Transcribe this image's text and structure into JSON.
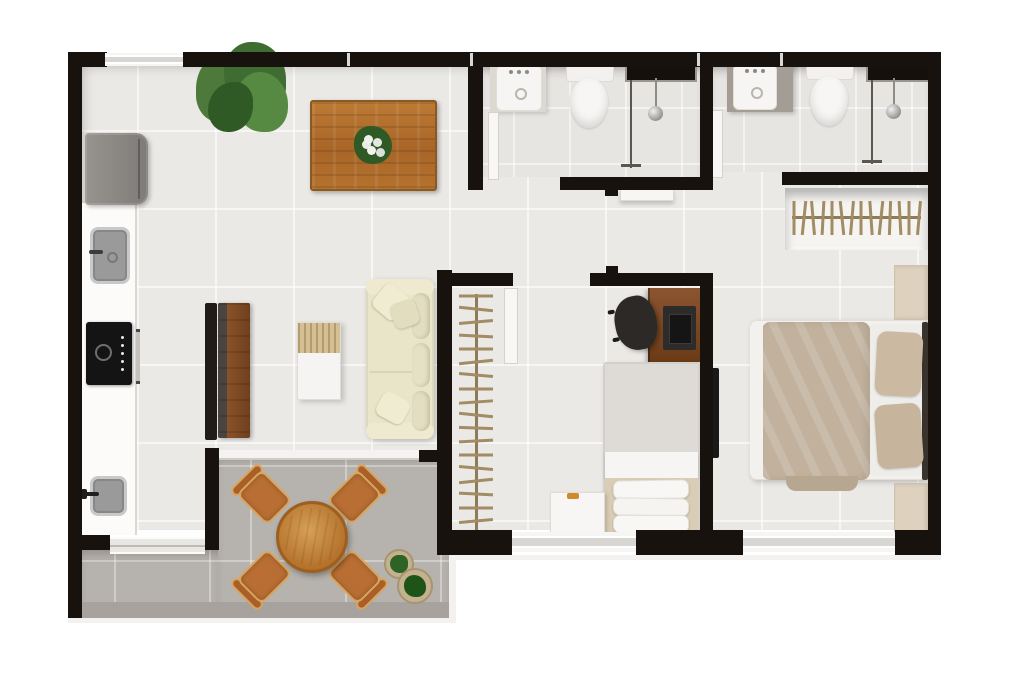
{
  "meta": {
    "type": "floor-plan",
    "description": "3D-rendered top-down floor plan of a two-bedroom apartment with two bathrooms, open kitchen/living/dining area and a balcony terrace"
  },
  "palette": {
    "wall": "#17120e",
    "floorMain": "#eae9e6",
    "floorBath": "#e7e5e2",
    "floorBalcony": "#b6b2ad",
    "curb": "#a7a29d",
    "windowGlass": "#d7d6d2",
    "counterWhite": "#fcfbfa",
    "counterGray": "#a39d96",
    "steelRim": "#c9c9c9",
    "fridge": "#8b8885",
    "cooktop": "#141414",
    "woodTable": "#b06f2e",
    "woodRack": "#84542a",
    "woodDesk": "#7c4a22",
    "chairGray": "#b5b3af",
    "sofa": "#e9e5c9",
    "coffeeWood": "#d5c094",
    "balconyWood": "#c08040",
    "balconyChair": "#b96f34",
    "balconyFrame": "#d9a55e",
    "plant": "#4d7a3b",
    "plantDark": "#2f5a25",
    "pot": "#c3b190",
    "blanket": "#c1b19d",
    "pillowBeige": "#cbb9a1",
    "bedGray": "#e6e3df",
    "nightstand": "#ded1be",
    "hanger": "#a28c64",
    "glassDark": "#14100d",
    "tvBlack": "#201c19"
  },
  "rooms": [
    {
      "id": "kitchen",
      "furniture": [
        "refrigerator",
        "white-counter",
        "steel-sink",
        "cooktop",
        "oven-handle",
        "wash-tub"
      ]
    },
    {
      "id": "dining-area",
      "furniture": [
        "wood-dining-table",
        "flower-centerpiece",
        "six-gray-chairs",
        "large-plant"
      ]
    },
    {
      "id": "living-room",
      "furniture": [
        "cream-sofa",
        "throw-pillows",
        "coffee-table",
        "wood-tv-rack",
        "tv-panel"
      ]
    },
    {
      "id": "bathroom-1",
      "furniture": [
        "washbasin",
        "toilet",
        "shower-glass",
        "shower-column"
      ]
    },
    {
      "id": "bathroom-2",
      "furniture": [
        "washbasin-gray-counter",
        "toilet",
        "shower-glass",
        "shower-column"
      ]
    },
    {
      "id": "hallway",
      "furniture": [
        "bench-shelf"
      ]
    },
    {
      "id": "bedroom-2",
      "furniture": [
        "open-closet-with-hangers",
        "desk",
        "monitor",
        "office-chair",
        "single-bed",
        "stacked-pillows",
        "nightstand",
        "decor-item"
      ]
    },
    {
      "id": "master-bedroom",
      "furniture": [
        "wardrobe-closet-with-hangers",
        "double-bed",
        "beige-blanket",
        "two-pillows",
        "nightstand-top",
        "nightstand-bottom",
        "wall-tv"
      ]
    },
    {
      "id": "balcony",
      "furniture": [
        "round-wood-table",
        "four-wood-chairs",
        "potted-plant-small",
        "potted-plant-large"
      ]
    }
  ]
}
